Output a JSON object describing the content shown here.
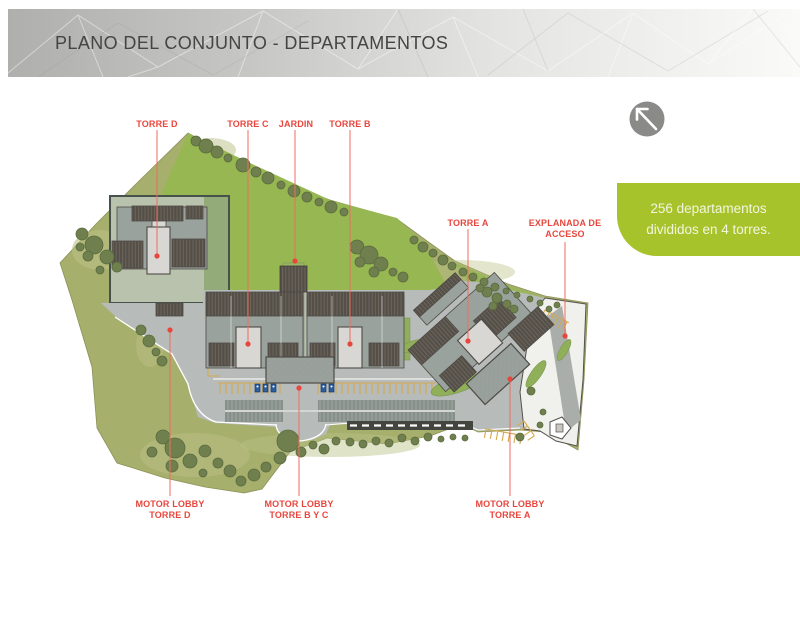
{
  "slide": {
    "title": "PLANO DEL CONJUNTO - DEPARTAMENTOS"
  },
  "info_box": {
    "line1": "256 departamentos",
    "line2": "divididos en 4 torres."
  },
  "north_arrow": {
    "direction": "up-left"
  },
  "plan_labels": {
    "torre_d": "TORRE D",
    "torre_c": "TORRE C",
    "jardin": "JARDIN",
    "torre_b": "TORRE B",
    "torre_a": "TORRE A",
    "explanada": {
      "line1": "EXPLANADA DE",
      "line2": "ACCESO"
    },
    "motor_lobby_d": {
      "line1": "MOTOR LOBBY",
      "line2": "TORRE D"
    },
    "motor_lobby_bc": {
      "line1": "MOTOR LOBBY",
      "line2": "TORRE B Y C"
    },
    "motor_lobby_a": {
      "line1": "MOTOR LOBBY",
      "line2": "TORRE A"
    }
  },
  "palette": {
    "label_red": "#E8463D",
    "leader_red": "#EE6E5F",
    "info_box_green": "#A6C32B",
    "info_box_text": "#F2F6DF",
    "site_olive": "#A7AF6D",
    "lawn_green": "#97B752",
    "plot_sage": "#B8C2AC",
    "road_gray": "#B7BCBA",
    "building_gray": "#9AA29E",
    "roof_dark": "#544F48",
    "core_light": "#D8D7D3",
    "tree_green": "#6F804E",
    "parking_yellow": "#D4A94E",
    "accessible_blue": "#2E5D9E",
    "north_circle": "#8A8A88",
    "title_gray": "#454543"
  }
}
